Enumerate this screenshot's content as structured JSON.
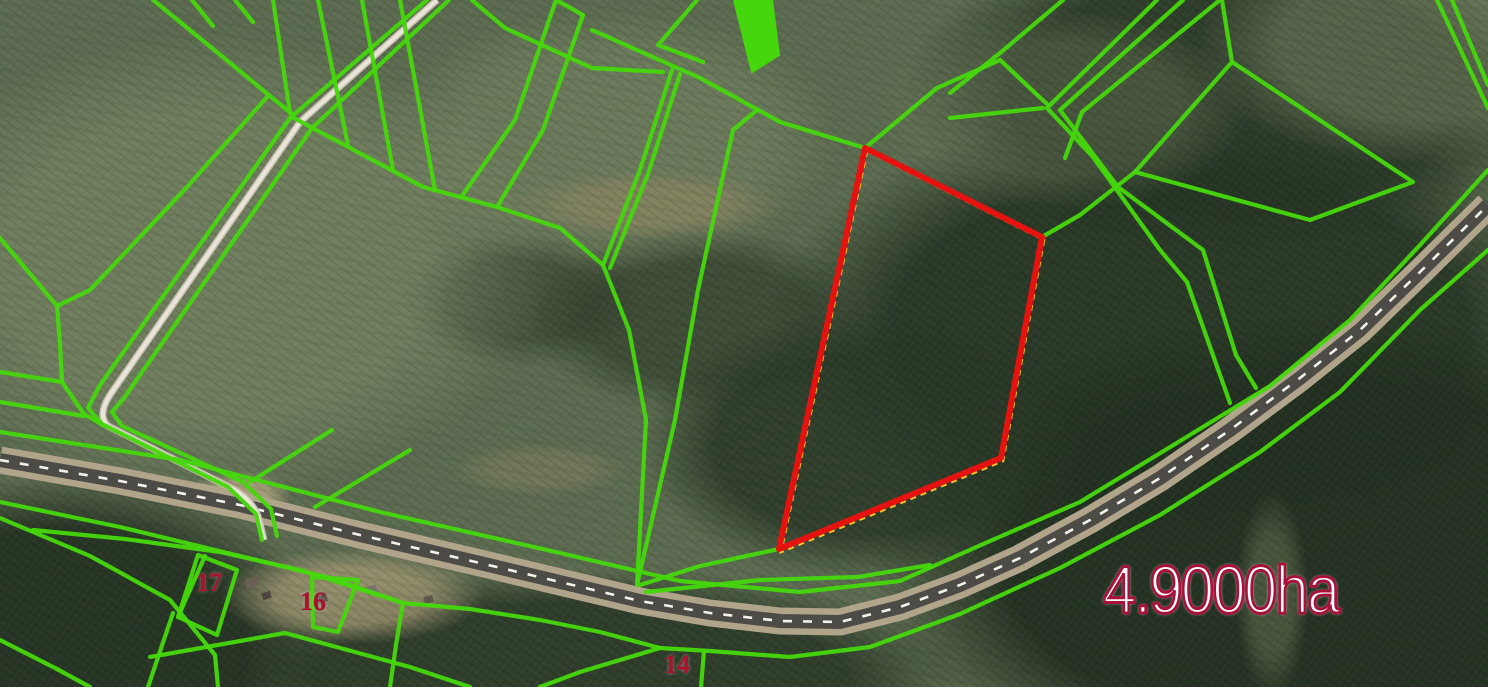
{
  "map": {
    "description": "cadastral-aerial-view",
    "colors": {
      "boundary_green": "#46d60d",
      "highlight_red": "#e51310",
      "highlight_accent_yellow": "#ffcf2e",
      "label_crimson": "#a8123a",
      "parcel_number_red": "#a8142c",
      "road_asphalt": "#4c4b45",
      "road_shoulder": "#b0a58b",
      "road_dash_white": "#f2f1ec",
      "track_gravel": "#e9e5da"
    },
    "area_label": {
      "text": "4.9000ha",
      "x": 1103,
      "y": 556
    },
    "parcel_numbers": [
      {
        "text": "17",
        "x": 196,
        "y": 570
      },
      {
        "text": "16",
        "x": 300,
        "y": 589
      },
      {
        "text": "14",
        "x": 664,
        "y": 652
      }
    ],
    "highlight_parcel": {
      "points": "865,148 1042,237 1001,458 779,549",
      "accent_points": "865,148 1042,237 1001,458 779,549",
      "stroke_width": 6
    },
    "road": {
      "center_path": "M0,460 L120,481 L240,505 L360,535 L480,563 L560,582 L640,601 L710,613 L780,621 L840,622 L900,607 L960,585 L1020,558 L1090,520 L1160,478 L1230,430 L1300,378 L1360,330 L1420,272 L1488,205",
      "dash_pattern": "9 11"
    },
    "track": {
      "path": "M437,0 L300,122 L112,392 Q96,415 108,426 L235,490 Q252,501 258,516 L264,540"
    },
    "boundaries": [
      "427,0 290,118 100,385 88,408 102,424 228,487 256,514 262,540",
      "449,0 312,128 124,398 112,412 122,426 243,482 271,509 277,536",
      "153,0 218,53 293,115",
      "192,0 213,26",
      "235,0 253,22",
      "267,97 187,187 90,290 57,306",
      "0,238 57,306 60,344 62,382",
      "0,372 62,382",
      "62,382 84,414 104,426",
      "0,402 84,416",
      "273,0 290,113",
      "318,0 348,145",
      "362,0 393,170",
      "400,0 435,190",
      "292,117 423,187 497,207 560,228 603,265",
      "556,0 515,120 462,196",
      "583,15 543,130 497,207",
      "556,0 583,15",
      "472,0 505,28 592,68 663,72",
      "592,30 700,78 780,122 865,148",
      "672,70 640,170 603,265",
      "680,74 648,174 610,268",
      "603,265 629,330 646,420 637,585",
      "757,110 733,130 698,290 675,420 637,585",
      "697,0 658,45 703,62",
      "865,148 937,88 1000,60 1048,105",
      "950,93 1000,53 1063,0",
      "950,118 1043,108",
      "1157,0 1047,108 1093,157 1160,250 1187,282 1230,403",
      "1183,0 1060,110 1118,187 1203,250 1236,355 1256,388",
      "1220,0 1082,112 1065,158",
      "1222,0 1232,62",
      "1232,62 1413,182 1310,220 1135,172 1232,62",
      "1135,172 1080,215 1042,237",
      "1437,0 1488,108",
      "1452,0 1488,85",
      "0,432 180,460 380,512 560,553 680,581 800,592 900,581 990,541 1080,502 1180,441 1270,386 1350,320 1420,245 1488,170",
      "0,502 120,527 240,556 330,578 403,603 470,609 540,620 600,632 660,648 710,651 790,657 870,647 960,614 1060,568 1160,515 1260,452 1340,392 1420,310 1488,250",
      "33,530 125,539 220,552 300,570 403,603",
      "403,603 396,645 390,687",
      "173,613 148,687",
      "178,617 205,556",
      "198,555 237,570 217,635 178,617 198,555",
      "312,577 358,580 338,632 313,627 312,577",
      "150,657 285,633 410,667 470,687",
      "0,640 55,668 90,687",
      "660,648 580,672 540,687",
      "704,651 701,687",
      "640,585 700,566 779,549",
      "646,592 760,580 858,577 930,565",
      "332,430 250,482",
      "410,450 315,507",
      "0,518 90,556 170,600 215,655 218,687"
    ],
    "filled_boundary_polygons": [
      "734,0 772,0 779,55 752,72"
    ],
    "buildings": [
      {
        "x": 246,
        "y": 578,
        "w": 12,
        "h": 9,
        "r": -18,
        "c": "#6b6055"
      },
      {
        "x": 262,
        "y": 592,
        "w": 9,
        "h": 7,
        "r": -18,
        "c": "#4e463e"
      },
      {
        "x": 314,
        "y": 594,
        "w": 13,
        "h": 9,
        "r": -15,
        "c": "#574e44"
      },
      {
        "x": 366,
        "y": 586,
        "w": 11,
        "h": 8,
        "r": -15,
        "c": "#7a7268"
      },
      {
        "x": 424,
        "y": 596,
        "w": 9,
        "h": 7,
        "r": -12,
        "c": "#5d554a"
      },
      {
        "x": 449,
        "y": 600,
        "w": 7,
        "h": 6,
        "r": -12,
        "c": "#6e655a"
      }
    ]
  }
}
